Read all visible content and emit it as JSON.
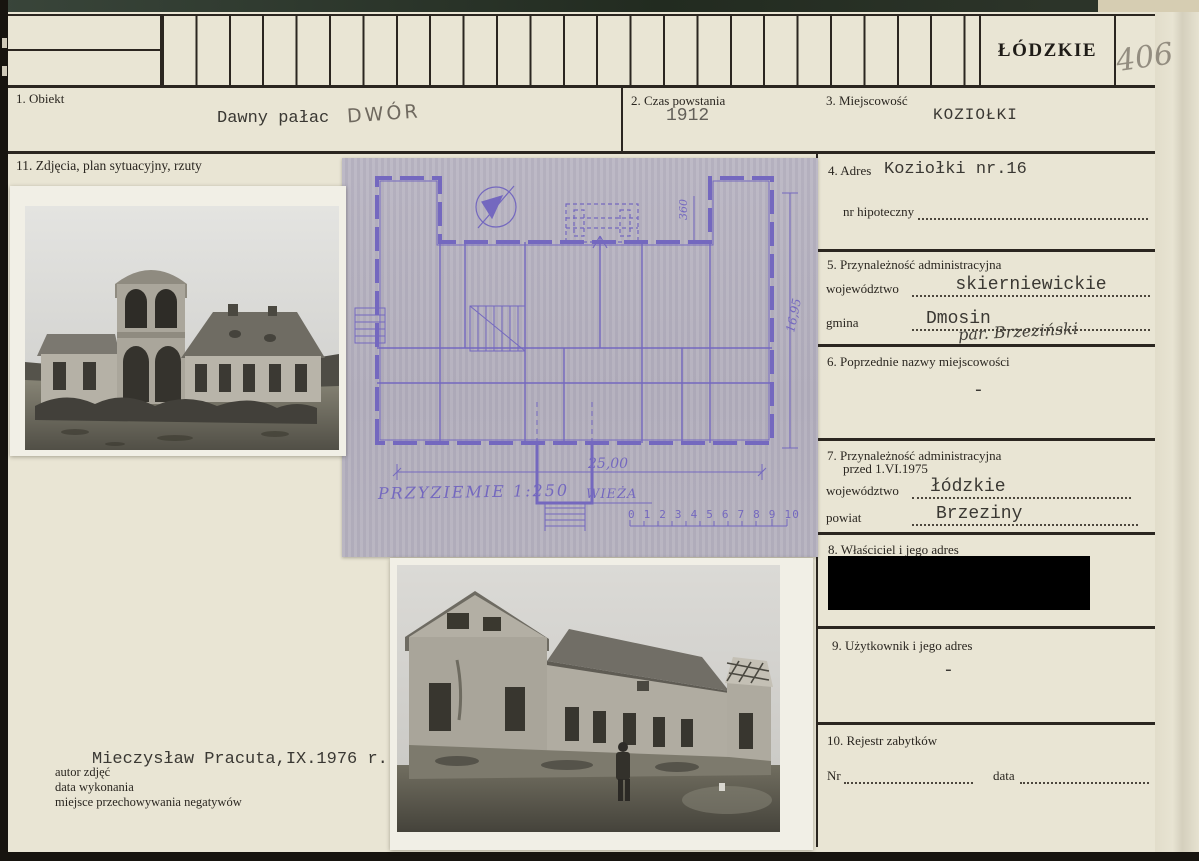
{
  "header": {
    "region_stamp": "ŁÓDZKIE",
    "card_number": "406"
  },
  "fields": {
    "obiekt": {
      "label": "1. Obiekt",
      "typed": "Dawny pałac",
      "handwritten": "DWÓR"
    },
    "czas": {
      "label": "2. Czas powstania",
      "value": "1912"
    },
    "miejscowosc": {
      "label": "3. Miejscowość",
      "value": "KOZIOŁKI"
    },
    "adres": {
      "label": "4. Adres",
      "value": "Koziołki nr.16",
      "hipoteczny_label": "nr hipoteczny"
    },
    "przynaleznosc": {
      "label": "5. Przynależność administracyjna",
      "wojewodztwo_label": "województwo",
      "wojewodztwo": "skierniewickie",
      "gmina_label": "gmina",
      "gmina": "Dmosin",
      "gmina_handwritten": "par. Brzeziński"
    },
    "poprzednie": {
      "label": "6. Poprzednie nazwy miejscowości",
      "value": "-"
    },
    "przynaleznosc_1975": {
      "label": "7. Przynależność administracyjna",
      "label2": "przed 1.VI.1975",
      "wojewodztwo_label": "województwo",
      "wojewodztwo": "łódzkie",
      "powiat_label": "powiat",
      "powiat": "Brzeziny"
    },
    "wlasciciel": {
      "label": "8. Właściciel i jego adres"
    },
    "uzytkownik": {
      "label": "9. Użytkownik i jego adres",
      "value": "-"
    },
    "rejestr": {
      "label": "10. Rejestr zabytków",
      "nr_label": "Nr",
      "data_label": "data"
    },
    "zdjecia": {
      "label": "11. Zdjęcia, plan sytuacyjny, rzuty"
    }
  },
  "plan": {
    "title": "PRZYZIEMIE 1:250",
    "tower_label": "WIEŻA",
    "width_dim": "25,00",
    "height_dim": "16,95",
    "top_dim": "360",
    "scale_numbers": "0 1 2 3 4 5 6 7 8 9 10"
  },
  "footer": {
    "author_label": "autor zdjęć",
    "author": "Mieczysław Pracuta,IX.1976 r.",
    "date_label": "data wykonania",
    "negatives_label": "miejsce przechowywania negatywów"
  },
  "colors": {
    "paper": "#e9e5d4",
    "ink": "#2b2620",
    "blueprint_paper": "#b6b2bf",
    "blueprint_ink": "#7468bf",
    "pencil": "#938d80",
    "redaction": "#000000"
  }
}
